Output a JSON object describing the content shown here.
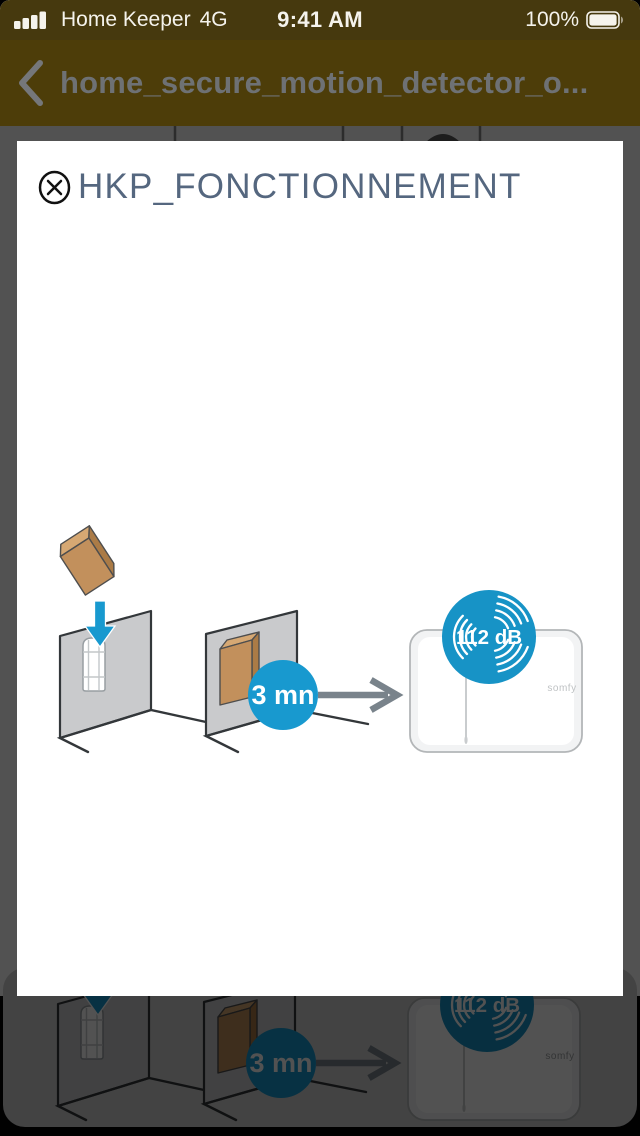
{
  "status_bar": {
    "carrier": "Home Keeper",
    "network": "4G",
    "time": "9:41 AM",
    "battery_percent": "100%"
  },
  "nav_bar": {
    "title": "home_secure_motion_detector_o..."
  },
  "modal": {
    "title": "HKP_FONCTIONNEMENT",
    "illustration": {
      "timer_label": "3 mn",
      "volume_label": "112 dB",
      "brand_label": "somfy"
    }
  },
  "background_preview": {
    "timer_label": "3 mn",
    "volume_label": "112 dB",
    "brand_label": "somfy"
  },
  "colors": {
    "accent_blue": "#1899cf",
    "badge_blue": "#1793c6",
    "bar_background_dimmed": "#4d3d09",
    "title_slate": "#55677f",
    "wall_gray": "#c9cacc",
    "cover_brown": "#c2905c"
  }
}
